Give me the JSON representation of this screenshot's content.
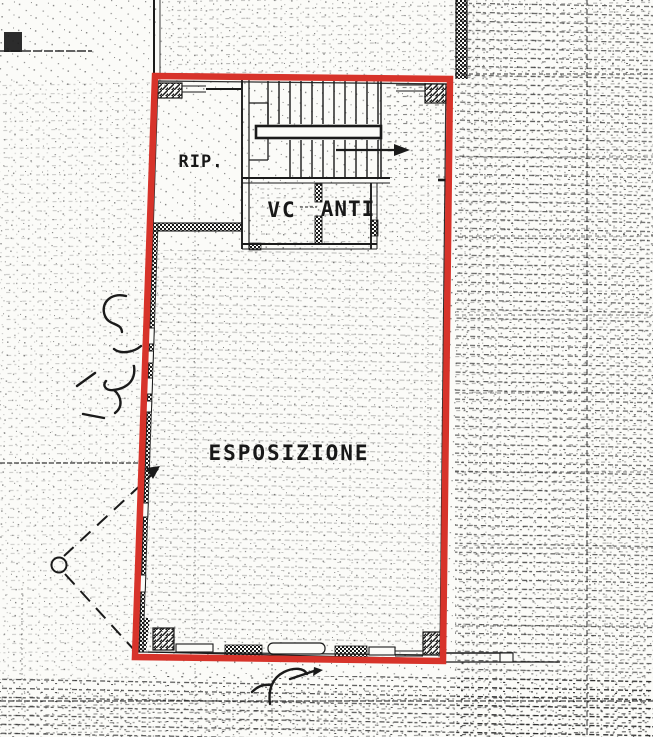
{
  "plan": {
    "colors": {
      "highlight_red": "#d7332a",
      "ink": "#1a1a1a",
      "paper": "#fbfbf8"
    },
    "rooms": {
      "rip": {
        "label": "RIP."
      },
      "vc": {
        "label": "VC"
      },
      "anti": {
        "label": "ANTI"
      },
      "esposizione": {
        "label": "ESPOSIZIONE"
      }
    },
    "annotations": {
      "left_handwritten_text": "5",
      "bottom_handwritten_text": "7"
    }
  }
}
